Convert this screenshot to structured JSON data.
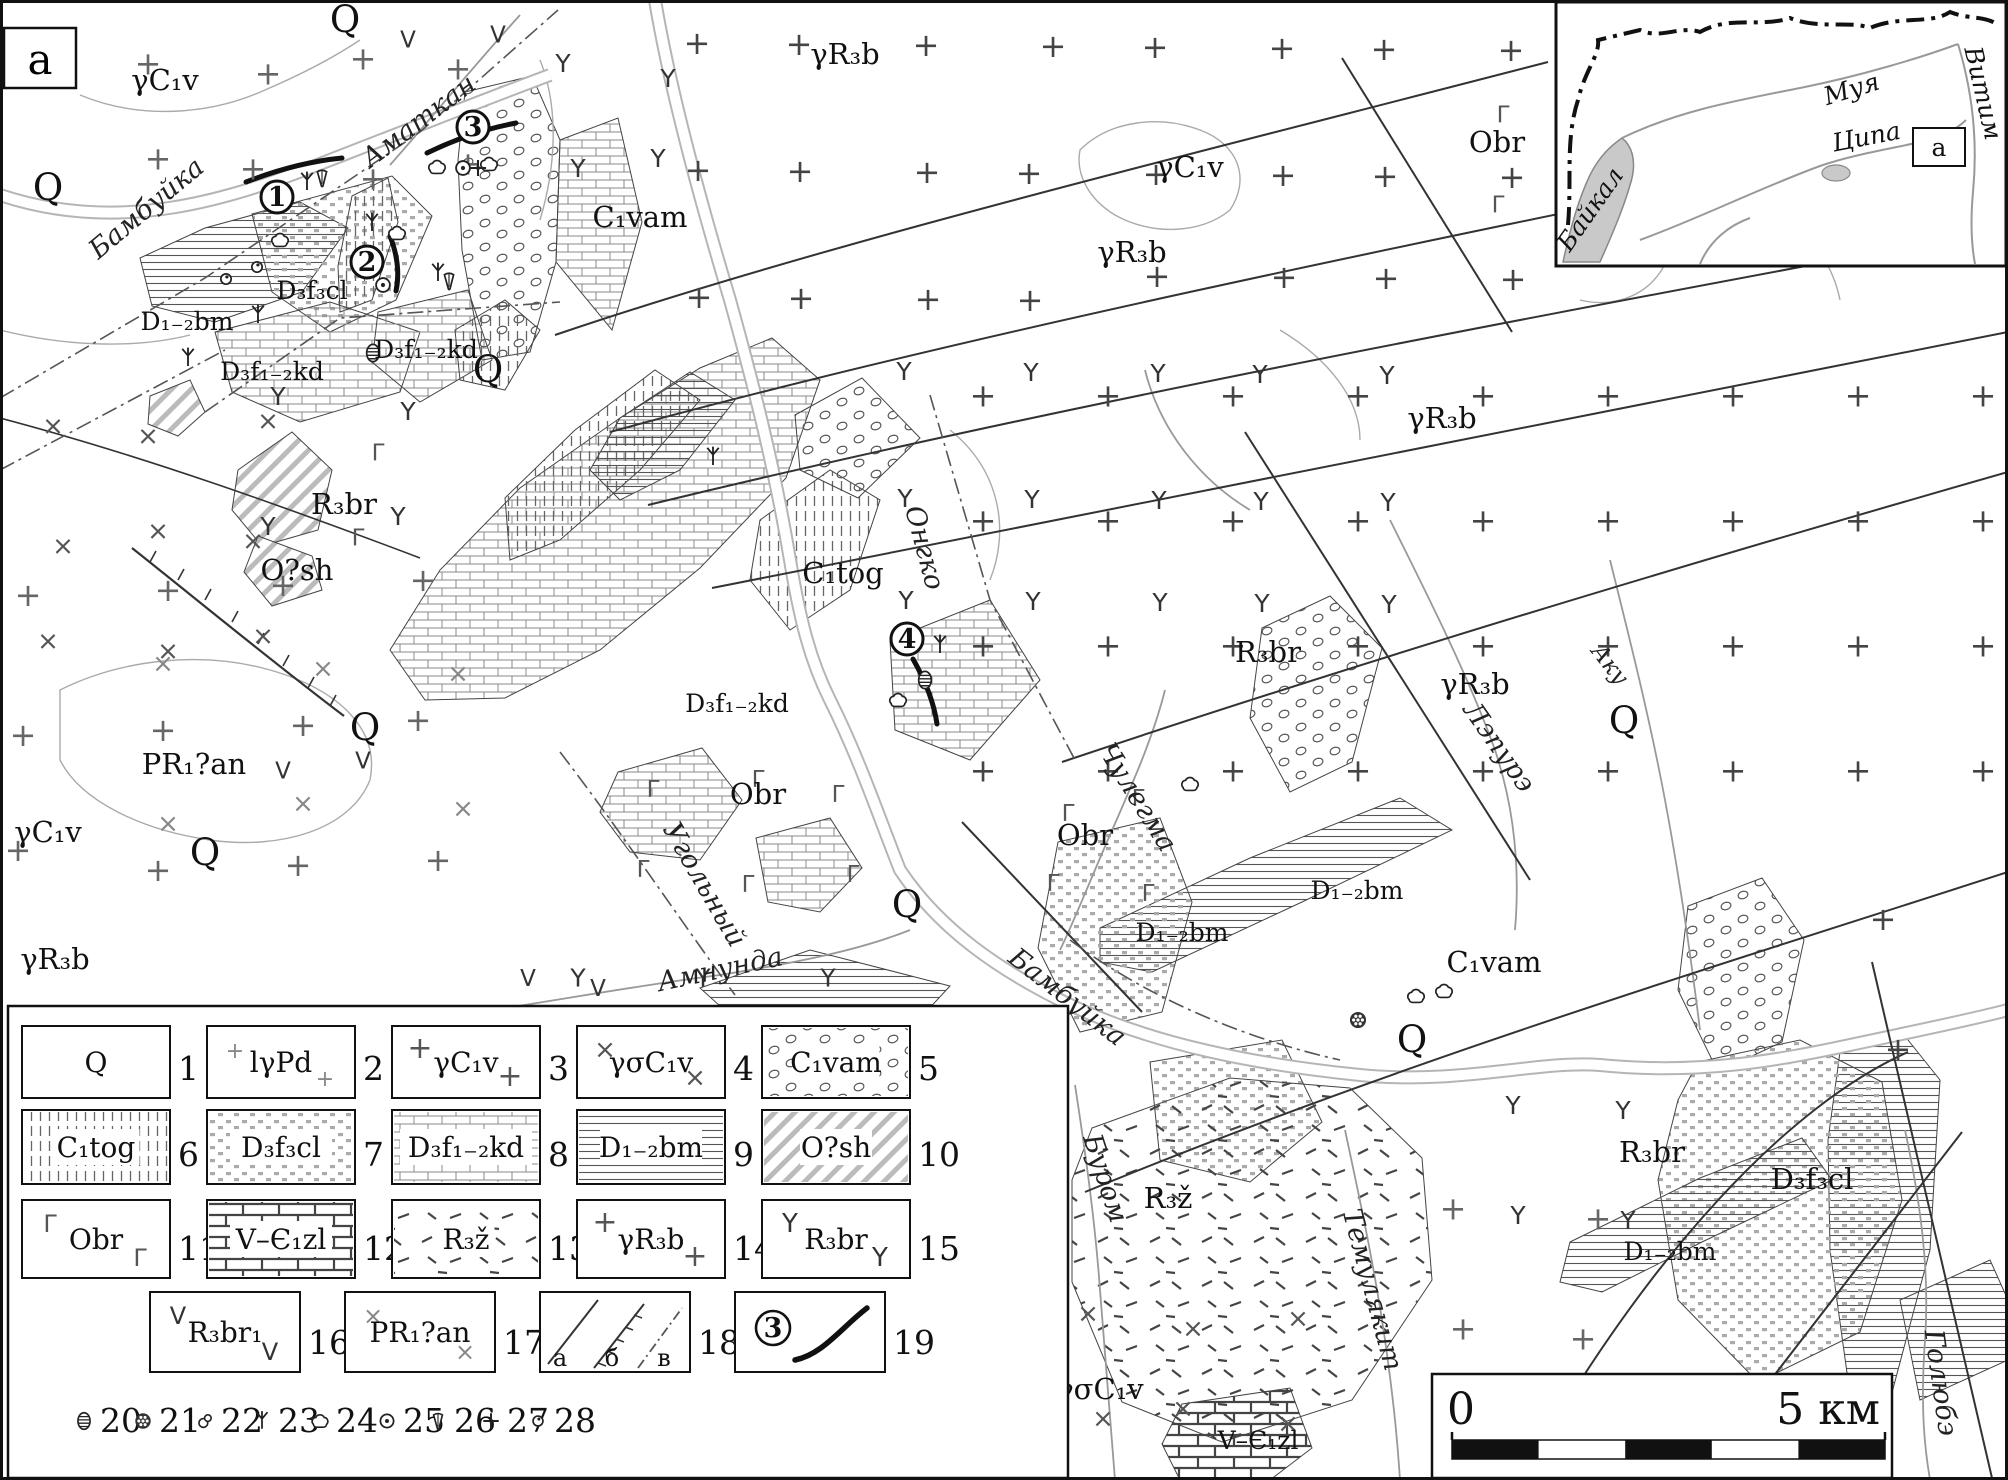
{
  "page": {
    "corner_label": "a"
  },
  "scalebar": {
    "zero": "0",
    "right": "5 км"
  },
  "inset": {
    "box_label": "а",
    "labels": [
      {
        "t": "Байкал",
        "x": 1597,
        "y": 214,
        "r": -55,
        "c": "m-inset"
      },
      {
        "t": "Муя",
        "x": 1854,
        "y": 97,
        "r": -17,
        "c": "m-inset"
      },
      {
        "t": "Ципа",
        "x": 1868,
        "y": 145,
        "r": -11,
        "c": "m-inset"
      },
      {
        "t": "Витим",
        "x": 1975,
        "y": 95,
        "r": 77,
        "c": "m-inset"
      }
    ]
  },
  "map": {
    "labels": [
      {
        "t": "γC₁v",
        "x": 165,
        "y": 90,
        "c": "m-unit"
      },
      {
        "t": "Q",
        "x": 345,
        "y": 32,
        "c": "m-big"
      },
      {
        "t": "Q",
        "x": 48,
        "y": 200,
        "c": "m-big"
      },
      {
        "t": "γR₃b",
        "x": 845,
        "y": 64,
        "c": "m-unit"
      },
      {
        "t": "γC₁v",
        "x": 1190,
        "y": 177,
        "c": "m-unit"
      },
      {
        "t": "γR₃b",
        "x": 1132,
        "y": 262,
        "c": "m-unit"
      },
      {
        "t": "Obr",
        "x": 1497,
        "y": 152,
        "c": "m-unit"
      },
      {
        "t": "γR₃b",
        "x": 1442,
        "y": 428,
        "c": "m-unit"
      },
      {
        "t": "D₁₋₂bm",
        "x": 187,
        "y": 330,
        "c": "m-unitS"
      },
      {
        "t": "D₃f₃cl",
        "x": 312,
        "y": 299,
        "c": "m-unitS"
      },
      {
        "t": "D₃f₁₋₂kd",
        "x": 272,
        "y": 380,
        "c": "m-unitS"
      },
      {
        "t": "D₃f₁₋₂kd",
        "x": 426,
        "y": 358,
        "c": "m-unitS"
      },
      {
        "t": "C₁vam",
        "x": 640,
        "y": 227,
        "c": "m-unit"
      },
      {
        "t": "Q",
        "x": 488,
        "y": 382,
        "c": "m-big"
      },
      {
        "t": "R₃br",
        "x": 344,
        "y": 514,
        "c": "m-unit"
      },
      {
        "t": "O?sh",
        "x": 297,
        "y": 580,
        "c": "m-unit"
      },
      {
        "t": "C₁tog",
        "x": 843,
        "y": 583,
        "c": "m-unit"
      },
      {
        "t": "R₃br",
        "x": 1268,
        "y": 662,
        "c": "m-unit"
      },
      {
        "t": "γR₃b",
        "x": 1475,
        "y": 694,
        "c": "m-unit"
      },
      {
        "t": "D₃f₁₋₂kd",
        "x": 737,
        "y": 712,
        "c": "m-unitS"
      },
      {
        "t": "Obr",
        "x": 758,
        "y": 804,
        "c": "m-unit"
      },
      {
        "t": "PR₁?an",
        "x": 194,
        "y": 774,
        "c": "m-unit"
      },
      {
        "t": "Obr",
        "x": 1085,
        "y": 845,
        "c": "m-unit"
      },
      {
        "t": "γC₁v",
        "x": 48,
        "y": 842,
        "c": "m-unit"
      },
      {
        "t": "γR₃b",
        "x": 55,
        "y": 969,
        "c": "m-unit"
      },
      {
        "t": "Q",
        "x": 365,
        "y": 740,
        "c": "m-big"
      },
      {
        "t": "Q",
        "x": 205,
        "y": 865,
        "c": "m-big"
      },
      {
        "t": "Q",
        "x": 907,
        "y": 917,
        "c": "m-big"
      },
      {
        "t": "Q",
        "x": 1624,
        "y": 733,
        "c": "m-big"
      },
      {
        "t": "D₁₋₂bm",
        "x": 1182,
        "y": 941,
        "c": "m-unitS"
      },
      {
        "t": "D₁₋₂bm",
        "x": 1357,
        "y": 899,
        "c": "m-unitS"
      },
      {
        "t": "C₁vam",
        "x": 1494,
        "y": 972,
        "c": "m-unit"
      },
      {
        "t": "Q",
        "x": 1412,
        "y": 1052,
        "c": "m-big"
      },
      {
        "t": "R₃br",
        "x": 1652,
        "y": 1162,
        "c": "m-unit"
      },
      {
        "t": "R₃ž",
        "x": 1168,
        "y": 1208,
        "c": "m-unit"
      },
      {
        "t": "D₃f₃cl",
        "x": 1812,
        "y": 1189,
        "c": "m-unit"
      },
      {
        "t": "D₁₋₂bm",
        "x": 1670,
        "y": 1260,
        "c": "m-unitS"
      },
      {
        "t": "γσC₁v",
        "x": 1100,
        "y": 1399,
        "c": "m-unit"
      },
      {
        "t": "V–Є₁zl",
        "x": 1258,
        "y": 1449,
        "c": "m-unitS"
      },
      {
        "t": "Бамбуйка",
        "x": 152,
        "y": 215,
        "r": -40,
        "c": "m-river"
      },
      {
        "t": "Аматкан",
        "x": 424,
        "y": 128,
        "r": -37,
        "c": "m-river"
      },
      {
        "t": "Онгко",
        "x": 916,
        "y": 550,
        "r": 75,
        "c": "m-river"
      },
      {
        "t": "Чулегма",
        "x": 1130,
        "y": 802,
        "r": 58,
        "c": "m-river"
      },
      {
        "t": "Лэпурэ",
        "x": 1492,
        "y": 752,
        "r": 55,
        "c": "m-river"
      },
      {
        "t": "Аку",
        "x": 1604,
        "y": 669,
        "r": 52,
        "c": "m-riverS"
      },
      {
        "t": "Угольный",
        "x": 697,
        "y": 889,
        "r": 60,
        "c": "m-river"
      },
      {
        "t": "Амнунда",
        "x": 722,
        "y": 978,
        "r": -12,
        "c": "m-river"
      },
      {
        "t": "Бамбуйка",
        "x": 1062,
        "y": 1004,
        "r": 38,
        "c": "m-river"
      },
      {
        "t": "Буром",
        "x": 1097,
        "y": 1181,
        "r": 72,
        "c": "m-river"
      },
      {
        "t": "Темулякит",
        "x": 1364,
        "y": 1292,
        "r": 75,
        "c": "m-river"
      },
      {
        "t": "Голюбэ",
        "x": 1932,
        "y": 1384,
        "r": 82,
        "c": "m-river"
      }
    ],
    "deposit_numbers": [
      {
        "n": "1",
        "x": 277,
        "y": 197
      },
      {
        "n": "2",
        "x": 367,
        "y": 262
      },
      {
        "n": "3",
        "x": 473,
        "y": 127
      },
      {
        "n": "4",
        "x": 907,
        "y": 639
      }
    ],
    "symbols": [
      {
        "s": "trilobite",
        "x": 373,
        "y": 353
      },
      {
        "s": "trilobite",
        "x": 925,
        "y": 680
      },
      {
        "s": "coral",
        "x": 1358,
        "y": 1020
      },
      {
        "s": "plant",
        "x": 307,
        "y": 182
      },
      {
        "s": "plant",
        "x": 372,
        "y": 223
      },
      {
        "s": "plant",
        "x": 438,
        "y": 273
      },
      {
        "s": "plant",
        "x": 258,
        "y": 315
      },
      {
        "s": "plant",
        "x": 188,
        "y": 358
      },
      {
        "s": "plant",
        "x": 713,
        "y": 457
      },
      {
        "s": "plant",
        "x": 940,
        "y": 645
      },
      {
        "s": "cloud",
        "x": 437,
        "y": 167
      },
      {
        "s": "cloud",
        "x": 489,
        "y": 164
      },
      {
        "s": "cloud",
        "x": 397,
        "y": 233
      },
      {
        "s": "cloud",
        "x": 280,
        "y": 240
      },
      {
        "s": "cloud",
        "x": 898,
        "y": 700
      },
      {
        "s": "cloud",
        "x": 1416,
        "y": 996
      },
      {
        "s": "cloud",
        "x": 1444,
        "y": 991
      },
      {
        "s": "cloud",
        "x": 1190,
        "y": 784
      },
      {
        "s": "dotc",
        "x": 463,
        "y": 168
      },
      {
        "s": "dotc",
        "x": 383,
        "y": 285
      },
      {
        "s": "cone",
        "x": 322,
        "y": 178
      },
      {
        "s": "cone",
        "x": 449,
        "y": 281
      },
      {
        "s": "fcross",
        "x": 478,
        "y": 168
      },
      {
        "s": "cup",
        "x": 257,
        "y": 267
      },
      {
        "s": "cup",
        "x": 226,
        "y": 279
      }
    ],
    "scatter": [
      {
        "g": "+",
        "r": [
          70,
          25,
          480,
          160
        ],
        "step": 105,
        "c": "#666"
      },
      {
        "g": "+",
        "r": [
          600,
          10,
          940,
          330
        ],
        "step": 118,
        "c": "#444"
      },
      {
        "g": "+",
        "r": [
          960,
          340,
          1048,
          440
        ],
        "step": 125,
        "c": "#444"
      },
      {
        "g": "+",
        "r": [
          0,
          540,
          430,
          460
        ],
        "step": 135,
        "c": "#666"
      },
      {
        "g": "+",
        "r": [
          1830,
          880,
          170,
          240
        ],
        "step": 120,
        "c": "#444"
      },
      {
        "g": "+",
        "r": [
          1380,
          1160,
          220,
          300
        ],
        "step": 130,
        "c": "#666"
      },
      {
        "g": "×",
        "r": [
          40,
          390,
          240,
          330
        ],
        "step": 105,
        "c": "#555"
      },
      {
        "g": "×",
        "r": [
          1075,
          1290,
          260,
          185
        ],
        "step": 95,
        "c": "#555"
      },
      {
        "g": "×",
        "r": [
          150,
          620,
          380,
          330
        ],
        "step": 140,
        "c": "#888"
      },
      {
        "g": "Y",
        "r": [
          830,
          330,
          620,
          400
        ],
        "step": 118,
        "c": "#333"
      },
      {
        "g": "Y",
        "r": [
          260,
          360,
          240,
          190
        ],
        "step": 120,
        "c": "#333"
      },
      {
        "g": "Y",
        "r": [
          1440,
          1060,
          300,
          230
        ],
        "step": 115,
        "c": "#333"
      },
      {
        "g": "Y",
        "r": [
          540,
          930,
          330,
          130
        ],
        "step": 125,
        "c": "#333"
      },
      {
        "g": "Y",
        "r": [
          560,
          40,
          150,
          140
        ],
        "step": 95,
        "c": "#333"
      },
      {
        "g": "V",
        "r": [
          400,
          0,
          180,
          75
        ],
        "step": 85,
        "c": "#333"
      },
      {
        "g": "V",
        "r": [
          495,
          950,
          130,
          70
        ],
        "step": 80,
        "c": "#333"
      },
      {
        "g": "V",
        "r": [
          280,
          740,
          90,
          60
        ],
        "step": 70,
        "c": "#333"
      },
      {
        "g": "Γ",
        "r": [
          610,
          750,
          300,
          180
        ],
        "step": 95,
        "c": "#555"
      },
      {
        "g": "Γ",
        "r": [
          1030,
          780,
          170,
          130
        ],
        "step": 80,
        "c": "#555"
      },
      {
        "g": "Γ",
        "r": [
          1440,
          80,
          130,
          170
        ],
        "step": 85,
        "c": "#555"
      },
      {
        "g": "Γ",
        "r": [
          290,
          420,
          140,
          140
        ],
        "step": 90,
        "c": "#555"
      }
    ]
  },
  "legend": {
    "items": [
      {
        "num": "1",
        "label": "Q",
        "kind": "blank"
      },
      {
        "num": "2",
        "label": "lγPd",
        "kind": "glyph",
        "g": "+",
        "gc": "#888",
        "gs": 22
      },
      {
        "num": "3",
        "label": "γC₁v",
        "kind": "glyph",
        "g": "+",
        "gc": "#555",
        "gs": 30
      },
      {
        "num": "4",
        "label": "γσC₁v",
        "kind": "glyph",
        "g": "×",
        "gc": "#555",
        "gs": 26
      },
      {
        "num": "5",
        "label": "C₁vam",
        "kind": "fill",
        "fill": "pat-vam"
      },
      {
        "num": "6",
        "label": "C₁tog",
        "kind": "fill",
        "fill": "pat-tog"
      },
      {
        "num": "7",
        "label": "D₃f₃cl",
        "kind": "fill",
        "fill": "pat-cl"
      },
      {
        "num": "8",
        "label": "D₃f₁₋₂kd",
        "kind": "fill",
        "fill": "pat-kd"
      },
      {
        "num": "9",
        "label": "D₁₋₂bm",
        "kind": "fill",
        "fill": "pat-bm"
      },
      {
        "num": "10",
        "label": "O?sh",
        "kind": "fill",
        "fill": "pat-sh"
      },
      {
        "num": "11",
        "label": "Obr",
        "kind": "glyph",
        "g": "Γ",
        "gc": "#555",
        "gs": 24
      },
      {
        "num": "12",
        "label": "V–Є₁zl",
        "kind": "fill",
        "fill": "pat-zl"
      },
      {
        "num": "13",
        "label": "R₃ž",
        "kind": "fill",
        "fill": "pat-z"
      },
      {
        "num": "14",
        "label": "γR₃b",
        "kind": "glyph",
        "g": "+",
        "gc": "#555",
        "gs": 30
      },
      {
        "num": "15",
        "label": "R₃br",
        "kind": "glyph",
        "g": "Y",
        "gc": "#333",
        "gs": 26
      },
      {
        "num": "16",
        "label": "R₃br₁",
        "kind": "glyph",
        "g": "V",
        "gc": "#333",
        "gs": 24
      },
      {
        "num": "17",
        "label": "PR₁?an",
        "kind": "glyph",
        "g": "×",
        "gc": "#888",
        "gs": 24
      },
      {
        "num": "18",
        "kind": "lines",
        "subs": [
          "а",
          "б",
          "в"
        ]
      },
      {
        "num": "19",
        "kind": "route",
        "mark": "3"
      }
    ],
    "symbol_items": [
      {
        "num": "20",
        "sym": "trilobite"
      },
      {
        "num": "21",
        "sym": "coral"
      },
      {
        "num": "22",
        "sym": "brach"
      },
      {
        "num": "23",
        "sym": "plant"
      },
      {
        "num": "24",
        "sym": "cloud"
      },
      {
        "num": "25",
        "sym": "dotc"
      },
      {
        "num": "26",
        "sym": "cone"
      },
      {
        "num": "27",
        "sym": "fcross"
      },
      {
        "num": "28",
        "sym": "cup"
      }
    ]
  }
}
